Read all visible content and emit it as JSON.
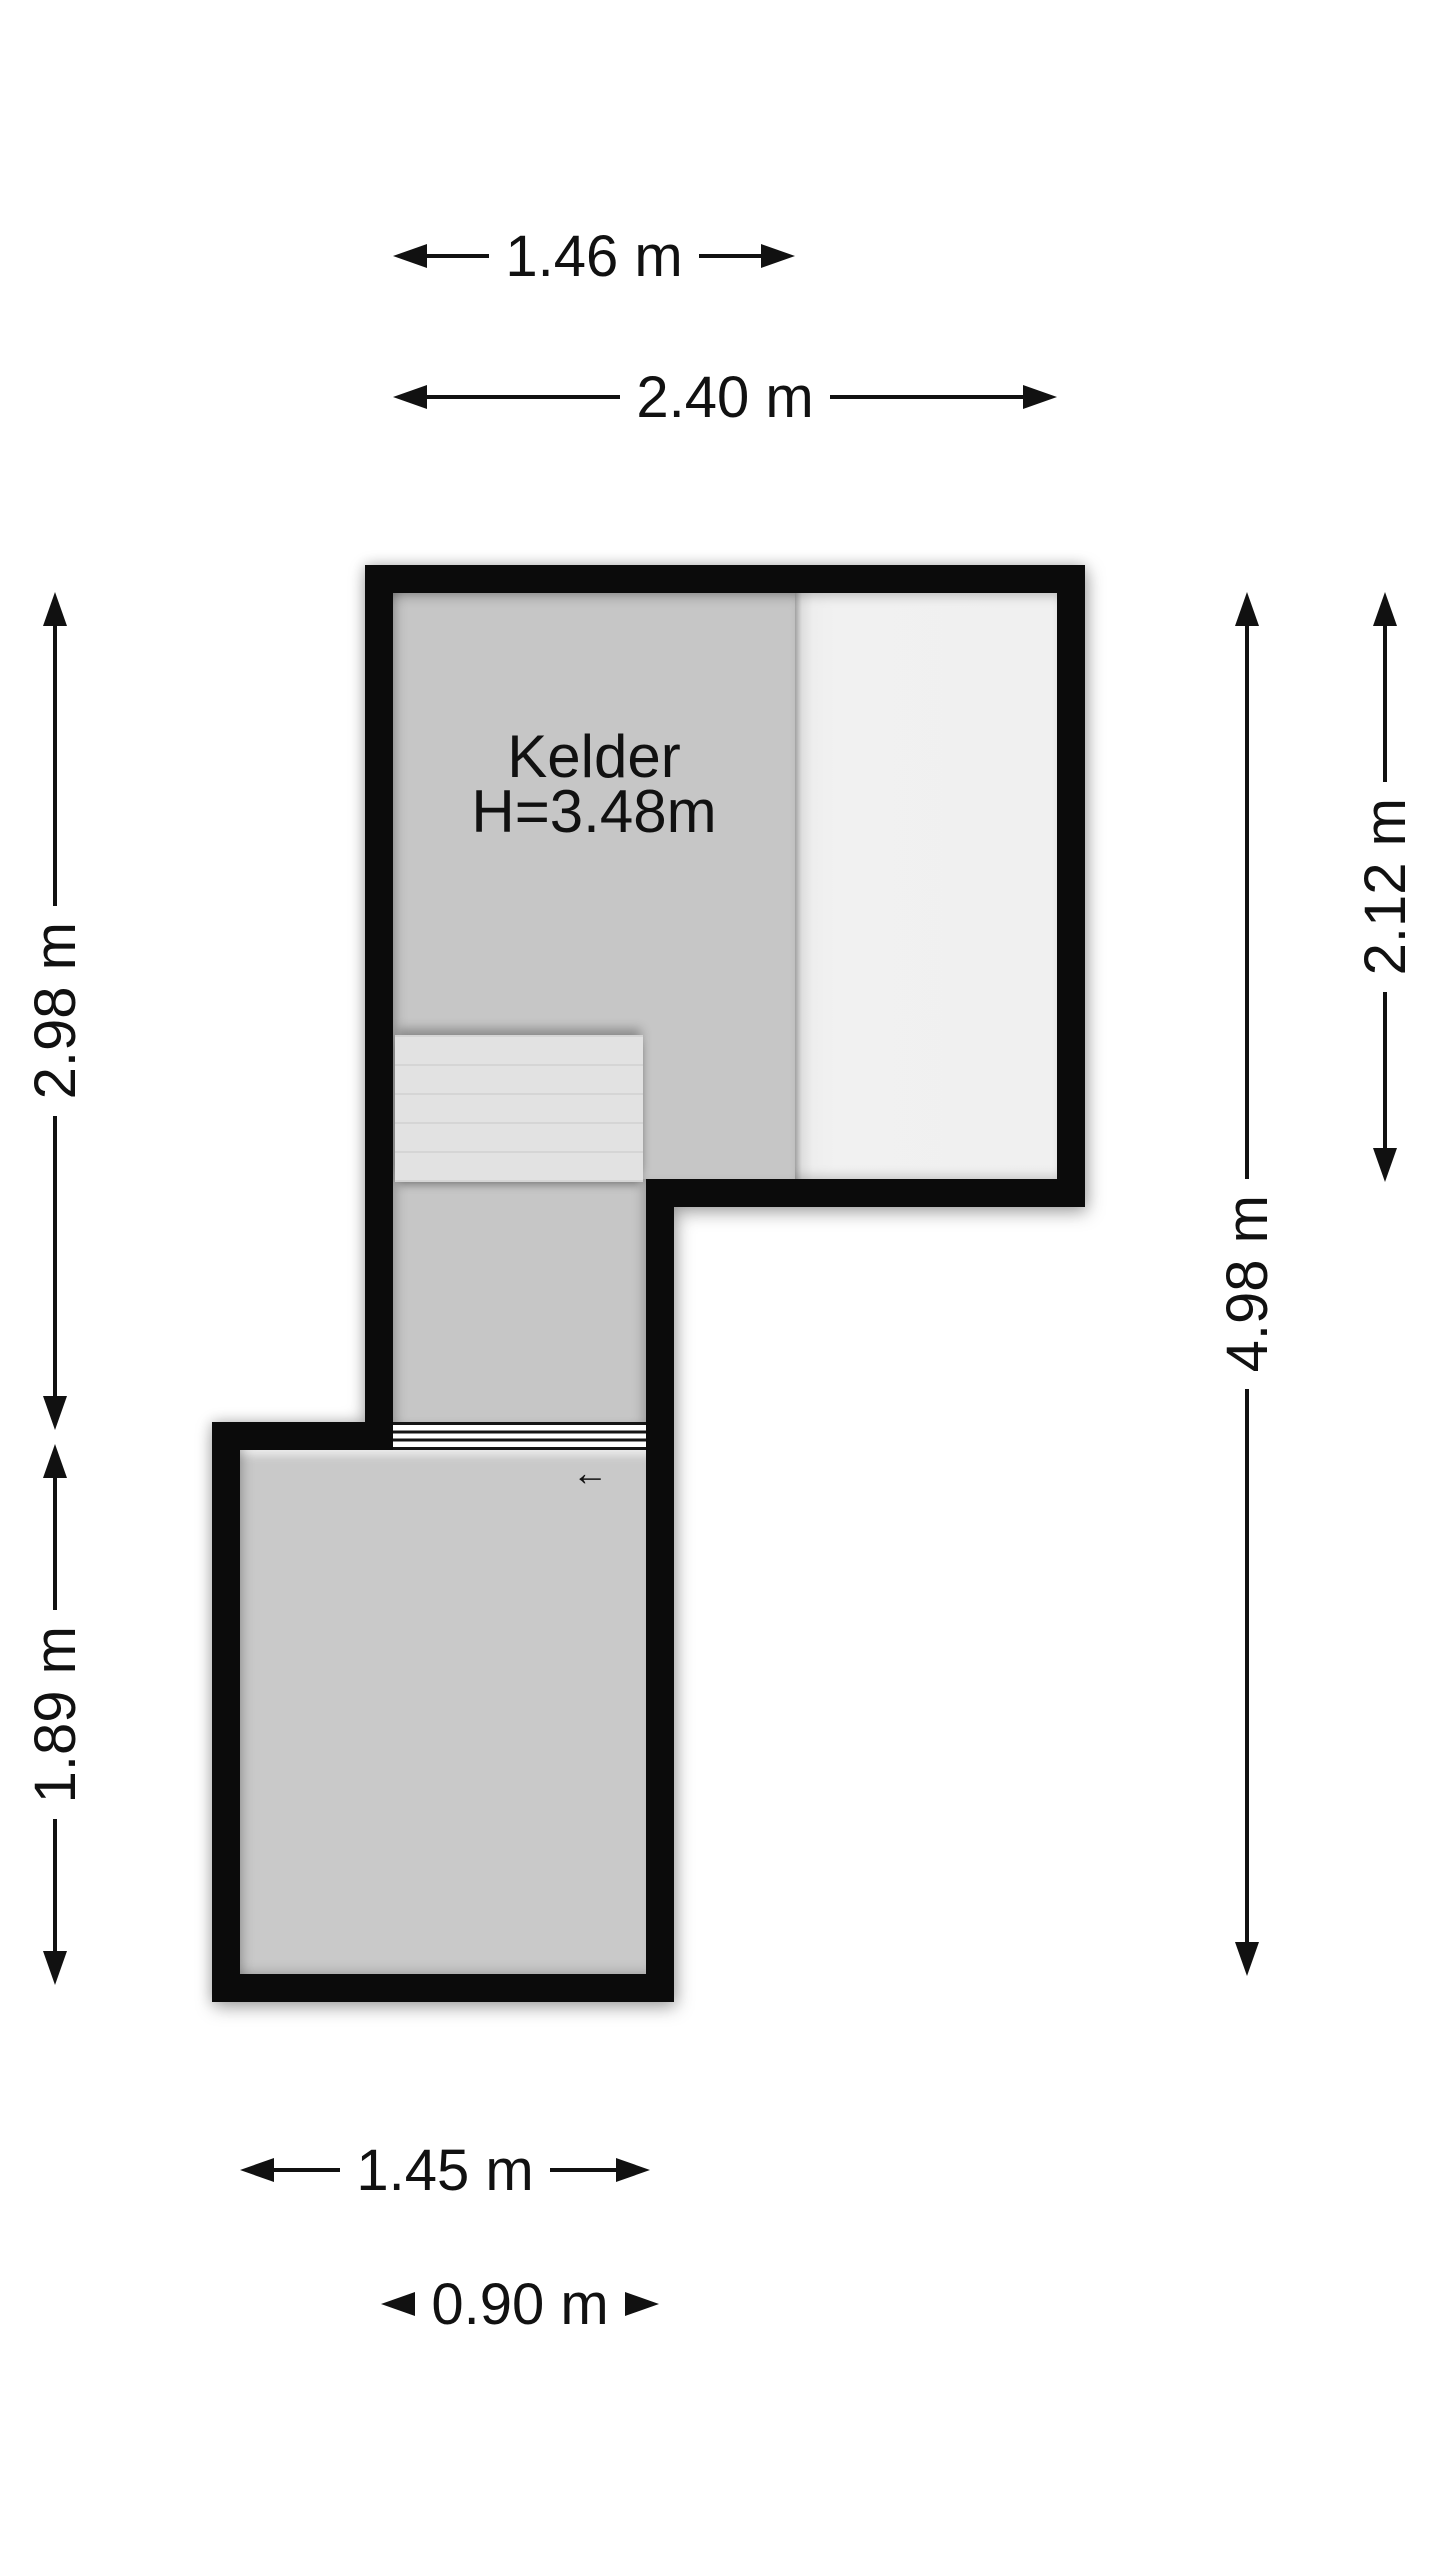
{
  "page": {
    "type": "floor-plan-drawing",
    "floor_name": "Kelder"
  },
  "plan": {
    "room": {
      "name": "Kelder",
      "ceiling_height": "H=3.48m"
    },
    "stair_direction_arrow": "←"
  },
  "dimensions": {
    "top_kelder_width": "1.46 m",
    "top_total_width": "2.40 m",
    "left_upper_height": "2.98 m",
    "left_lower_height": "1.89 m",
    "right_upper_height": "2.12 m",
    "right_total_height": "4.98 m",
    "bottom_lower_width": "1.45 m",
    "bottom_corridor_width": "0.90 m"
  },
  "colors": {
    "background": "#ffffff",
    "wall": "#0b0b0b",
    "floor_gray": "#c6c6c6",
    "light_area": "#f0f0f0",
    "stairs": "#e2e2e2",
    "text": "#111111"
  }
}
